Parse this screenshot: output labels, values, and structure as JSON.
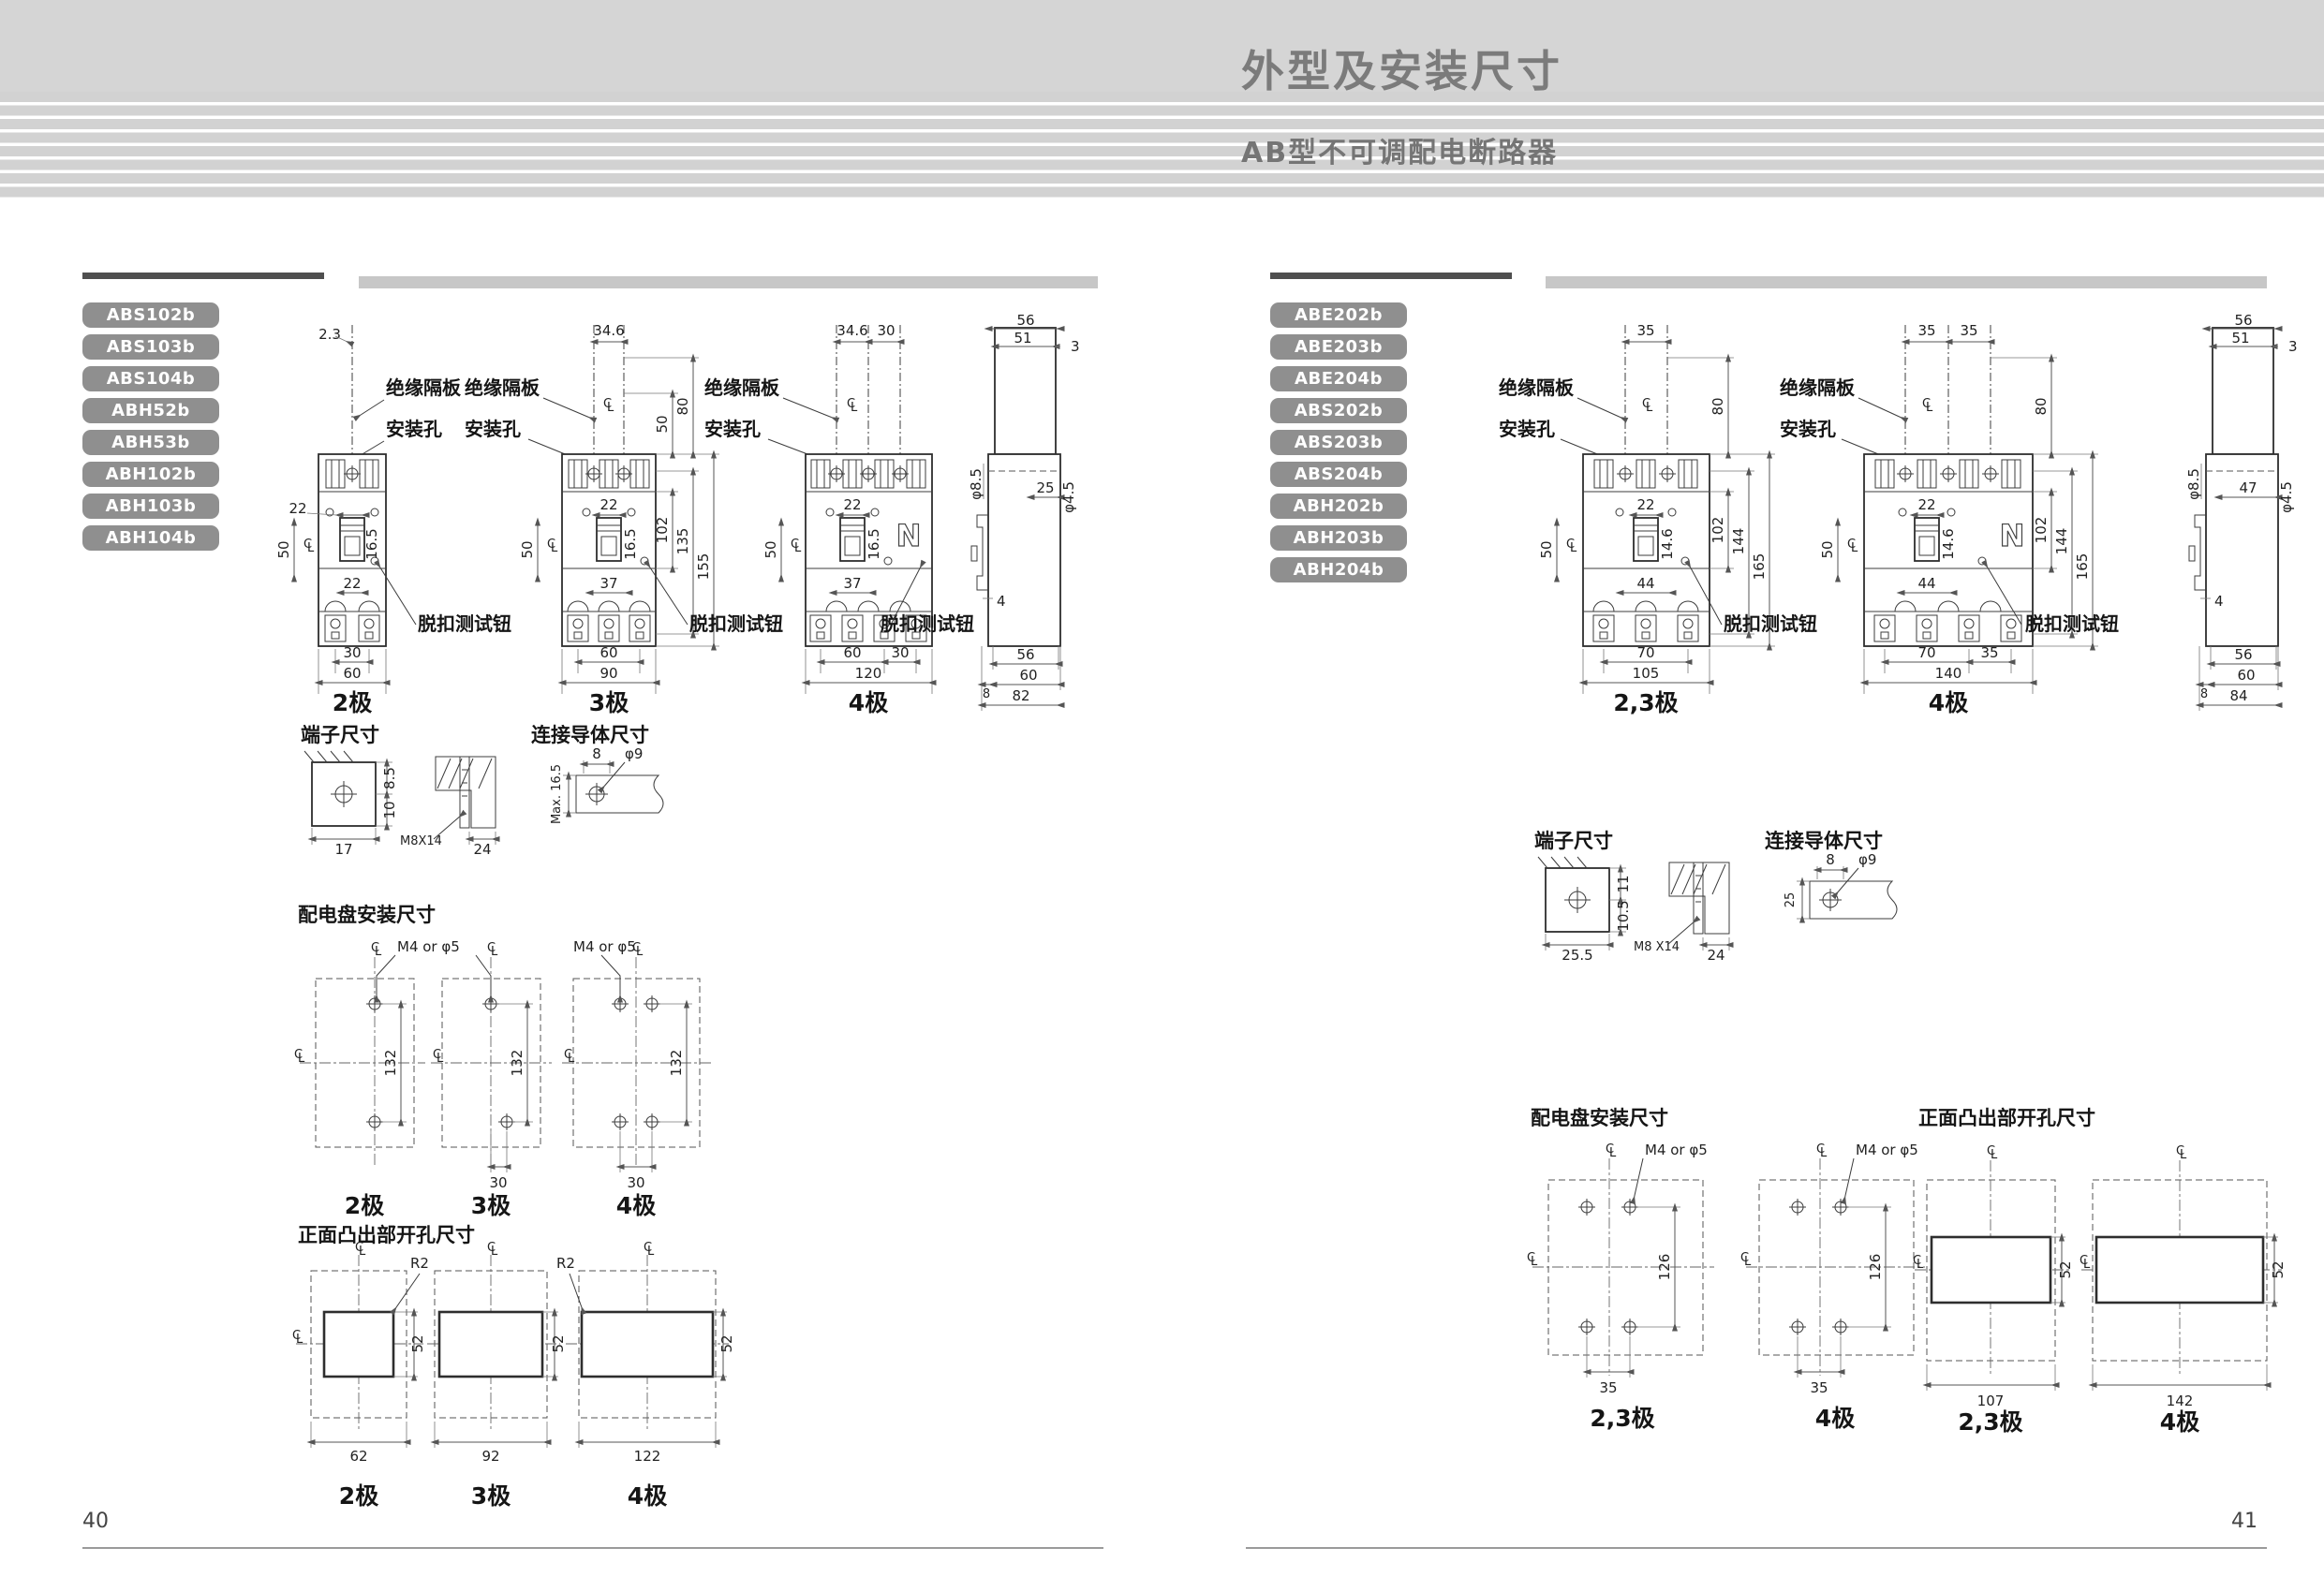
{
  "header": {
    "title": "外型及安装尺寸",
    "subtitle": "AB型不可调配电断路器"
  },
  "labels": {
    "insulation": "绝缘隔板",
    "mounting_hole": "安装孔",
    "trip_test": "脱扣测试钮",
    "neutral": "N",
    "m4": "M4 or φ5",
    "r2": "R2",
    "cl_c": "C",
    "cl_l": "L"
  },
  "left_page": {
    "page_number": "40",
    "models": [
      "ABS102b",
      "ABS103b",
      "ABS104b",
      "ABH52b",
      "ABH53b",
      "ABH102b",
      "ABH103b",
      "ABH104b"
    ],
    "pole2": {
      "caption": "2极",
      "top": "2.3",
      "w22": "22",
      "h165": "16.5",
      "left50": "50",
      "below": "22",
      "b1": "30",
      "b2": "60"
    },
    "pole3": {
      "caption": "3极",
      "top": "34.6",
      "r50": "50",
      "r80": "80",
      "r102": "102",
      "r135": "135",
      "r155": "155",
      "w22": "22",
      "h165": "16.5",
      "left50": "50",
      "below": "37",
      "b1": "60",
      "b2": "90"
    },
    "pole4": {
      "caption": "4极",
      "t1": "34.6",
      "t2": "30",
      "w22": "22",
      "h165": "16.5",
      "left50": "50",
      "below": "37",
      "b1": "60",
      "b2": "30",
      "b3": "120"
    },
    "side": {
      "t56": "56",
      "t51": "51",
      "t3": "3",
      "d85": "φ8.5",
      "w25": "25",
      "d45": "φ4.5",
      "n4": "4",
      "b56": "56",
      "b8": "8",
      "b60": "60",
      "b82": "82"
    },
    "terminal": {
      "title": "端子尺寸",
      "w1": "17",
      "h1": "8.5",
      "h2": "10",
      "thread": "M8X14",
      "w2": "24"
    },
    "conductor": {
      "title": "连接导体尺寸",
      "w": "8",
      "hole": "φ9",
      "h": "Max. 16.5"
    },
    "panel": {
      "title": "配电盘安装尺寸",
      "v": "132",
      "p": "30",
      "captions": [
        "2极",
        "3极",
        "4极"
      ]
    },
    "front": {
      "title": "正面凸出部开孔尺寸",
      "h": "52",
      "widths": [
        "62",
        "92",
        "122"
      ],
      "captions": [
        "2极",
        "3极",
        "4极"
      ]
    }
  },
  "right_page": {
    "page_number": "41",
    "models": [
      "ABE202b",
      "ABE203b",
      "ABE204b",
      "ABS202b",
      "ABS203b",
      "ABS204b",
      "ABH202b",
      "ABH203b",
      "ABH204b"
    ],
    "pole23": {
      "caption": "2,3极",
      "top": "35",
      "r80": "80",
      "r102": "102",
      "r144": "144",
      "r165": "165",
      "w22": "22",
      "h146": "14.6",
      "left50": "50",
      "below": "44",
      "b1": "70",
      "b2": "105"
    },
    "pole4": {
      "caption": "4极",
      "t1": "35",
      "t2": "35",
      "r80": "80",
      "r102": "102",
      "r144": "144",
      "r165": "165",
      "w22": "22",
      "h146": "14.6",
      "left50": "50",
      "below": "44",
      "b1": "70",
      "b2": "35",
      "b3": "140"
    },
    "side": {
      "t56": "56",
      "t51": "51",
      "t3": "3",
      "d85": "φ8.5",
      "w47": "47",
      "d45": "φ4.5",
      "n4": "4",
      "b56": "56",
      "b8": "8",
      "b60": "60",
      "b84": "84"
    },
    "terminal": {
      "title": "端子尺寸",
      "w1": "25.5",
      "h1": "11",
      "h2": "10.5",
      "thread": "M8 X14",
      "w2": "24"
    },
    "conductor": {
      "title": "连接导体尺寸",
      "w": "8",
      "hole": "φ9",
      "h": "25"
    },
    "panel": {
      "title": "配电盘安装尺寸",
      "v": "126",
      "p": "35",
      "captions": [
        "2,3极",
        "4极"
      ]
    },
    "front": {
      "title": "正面凸出部开孔尺寸",
      "h": "52",
      "widths": [
        "107",
        "142"
      ],
      "captions": [
        "2,3极",
        "4极"
      ]
    }
  }
}
